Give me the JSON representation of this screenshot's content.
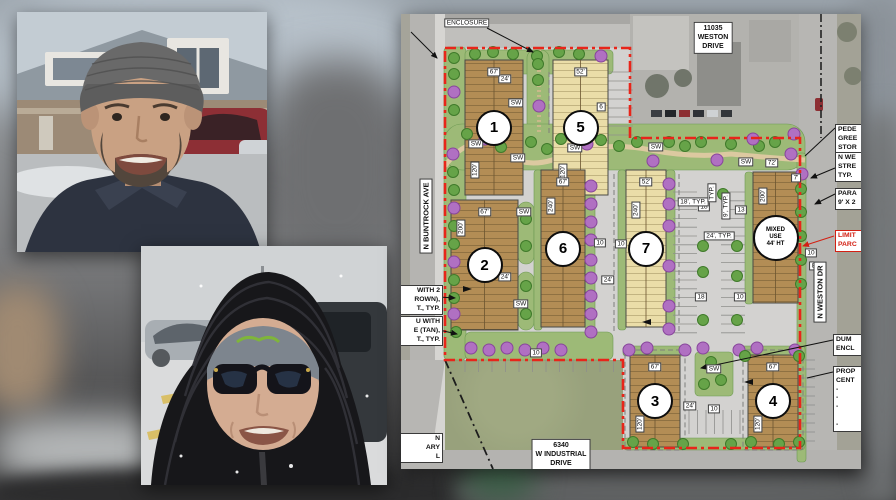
{
  "meta": {
    "description": "News composite: two winter portraits beside a colored development site plan overlaid on a blurred street photo"
  },
  "photos": {
    "man": {
      "name": "man-in-knit-beanie-portrait",
      "colors": {
        "sky": "#c3ccd3",
        "roof": "#8f99a1",
        "brick": "#9c8a76",
        "trim": "#e8e6e1",
        "suv_red": "#8d2f35",
        "skin": "#c9a183",
        "beanie": "#696969",
        "beard": "#52463c",
        "jacket": "#2d3340",
        "pavement": "#babdbf"
      }
    },
    "woman": {
      "name": "woman-in-puffer-hood-portrait",
      "colors": {
        "sky": "#d0d3d5",
        "snow": "#dadbdc",
        "car_silver": "#a8aeb3",
        "car_dark": "#34383c",
        "coat": "#17171a",
        "coat_hl": "#33333a",
        "beanie": "#7d858e",
        "beanie_logo": "#7fb53a",
        "skin": "#d4ac92",
        "glasses": "#14141a",
        "lines_yellow": "#d8b84a"
      }
    }
  },
  "plan": {
    "colors": {
      "aerial": "#c7c6c2",
      "site": "#d3d2d0",
      "road": "#b5b4b1",
      "grass": "#98a17c",
      "green": "#9dba77",
      "green_edge": "#6d9a52",
      "path": "#dcc9a0",
      "bldg_brown": "#b38d55",
      "bldg_tan": "#eadda8",
      "hatch": "#6b5530",
      "tree_green": "#66a348",
      "tree_green_edge": "#3f7a2a",
      "tree_purple": "#b070c2",
      "tree_purple_edge": "#87459b",
      "boundary_red": "#e8251a",
      "callout_red": "#d32013"
    },
    "area_label": {
      "t": "ENCLOSURE",
      "x": 66,
      "y": 9
    },
    "address_labels": [
      {
        "lines": [
          "11035",
          "WESTON",
          "DRIVE"
        ],
        "x": 312,
        "y": 24
      },
      {
        "lines": [
          "6340",
          "W INDUSTRIAL",
          "DRIVE"
        ],
        "x": 160,
        "y": 441
      }
    ],
    "street_labels": [
      {
        "t": "N BUNTROCK AVE",
        "x": 25,
        "y": 202,
        "r": -90
      },
      {
        "t": "N WESTON DR",
        "x": 419,
        "y": 278,
        "r": -90
      }
    ],
    "buildings": [
      {
        "n": "1",
        "x": 64,
        "y": 46,
        "w": 58,
        "h": 135,
        "f": "b",
        "td": "67'",
        "sd": "120'",
        "sdy": 156
      },
      {
        "n": "5",
        "x": 152,
        "y": 46,
        "w": 55,
        "h": 135,
        "f": "t",
        "td": "52'",
        "sd": "120'",
        "sdy": 158
      },
      {
        "n": "2",
        "x": 50,
        "y": 186,
        "w": 67,
        "h": 130,
        "f": "b",
        "td": "67'",
        "sd": "200'",
        "sdy": 214
      },
      {
        "n": "6",
        "x": 140,
        "y": 156,
        "w": 44,
        "h": 157,
        "f": "b",
        "td": "67'",
        "sd": "240'",
        "sdy": 192
      },
      {
        "n": "7",
        "x": 225,
        "y": 156,
        "w": 40,
        "h": 157,
        "f": "t",
        "td": "52'",
        "sd": "240'",
        "sdy": 196
      },
      {
        "n": "3",
        "x": 229,
        "y": 341,
        "w": 50,
        "h": 92,
        "f": "b",
        "td": "67'",
        "sd": "120'",
        "sdy": 410
      },
      {
        "n": "4",
        "x": 347,
        "y": 341,
        "w": 50,
        "h": 92,
        "f": "b",
        "td": "67'",
        "sd": "120'",
        "sdy": 410
      },
      {
        "n": "",
        "x": 352,
        "y": 158,
        "w": 45,
        "h": 131,
        "f": "b",
        "td": "",
        "sd": "200'",
        "sdy": 182,
        "circle_lines": [
          "MIXED",
          "USE",
          "44' HT"
        ]
      }
    ],
    "labels": [
      {
        "t": "SW",
        "x": 75,
        "y": 130
      },
      {
        "t": "SW",
        "x": 117,
        "y": 144
      },
      {
        "t": "SW",
        "x": 174,
        "y": 134
      },
      {
        "t": "SW",
        "x": 255,
        "y": 133
      },
      {
        "t": "SW",
        "x": 345,
        "y": 148
      },
      {
        "t": "SW",
        "x": 115,
        "y": 89
      },
      {
        "t": "SW",
        "x": 123,
        "y": 198
      },
      {
        "t": "SW",
        "x": 120,
        "y": 290
      },
      {
        "t": "SW",
        "x": 313,
        "y": 355
      },
      {
        "t": "6",
        "x": 200,
        "y": 93
      },
      {
        "t": "10",
        "x": 199,
        "y": 229
      },
      {
        "t": "10",
        "x": 220,
        "y": 230
      },
      {
        "t": "10",
        "x": 135,
        "y": 339
      },
      {
        "t": "10",
        "x": 339,
        "y": 283
      },
      {
        "t": "10",
        "x": 410,
        "y": 239
      },
      {
        "t": "10",
        "x": 313,
        "y": 395
      },
      {
        "t": "18",
        "x": 303,
        "y": 193
      },
      {
        "t": "18",
        "x": 300,
        "y": 283
      },
      {
        "t": "13",
        "x": 340,
        "y": 196
      },
      {
        "t": "24'",
        "x": 104,
        "y": 65
      },
      {
        "t": "24'",
        "x": 104,
        "y": 263
      },
      {
        "t": "24'",
        "x": 207,
        "y": 266
      },
      {
        "t": "24'",
        "x": 289,
        "y": 392
      },
      {
        "t": "72'",
        "x": 371,
        "y": 149
      },
      {
        "t": "7'",
        "x": 395,
        "y": 164
      },
      {
        "t": "8'",
        "x": 413,
        "y": 252
      },
      {
        "t": "18', TYP.",
        "x": 292,
        "y": 188
      },
      {
        "t": "24', TYP.",
        "x": 318,
        "y": 222
      },
      {
        "t": "9', TYP.",
        "x": 325,
        "y": 192,
        "r": -90
      },
      {
        "t": "TYP.",
        "x": 311,
        "y": 179,
        "r": -90
      }
    ],
    "callouts_right": [
      {
        "lines": [
          "PEDE",
          "GREE",
          "STOR"
        ],
        "x": 434,
        "y": 110
      },
      {
        "lines": [
          "N WE",
          "STRE",
          "TYP."
        ],
        "x": 434,
        "y": 138
      },
      {
        "lines": [
          "PARA",
          "9' X 2"
        ],
        "x": 434,
        "y": 174
      },
      {
        "lines": [
          "LIMIT",
          "PARC"
        ],
        "x": 434,
        "y": 216,
        "red": true
      },
      {
        "lines": [
          "DUM",
          "ENCL"
        ],
        "x": 432,
        "y": 320
      },
      {
        "lines": [
          "PROP",
          "CENT",
          "-",
          "-",
          "-",
          "",
          "-"
        ],
        "x": 432,
        "y": 352
      }
    ],
    "callouts_left": [
      {
        "lines": [
          "WITH 2",
          "ROWN),",
          "T., TYP."
        ],
        "y": 271
      },
      {
        "lines": [
          "U WITH",
          "E (TAN),",
          "T., TYP."
        ],
        "y": 302
      },
      {
        "lines": [
          "N",
          "ARY",
          "L"
        ],
        "y": 419
      }
    ],
    "trees": [
      [
        53,
        44,
        "g"
      ],
      [
        53,
        60,
        "g"
      ],
      [
        53,
        78,
        "p"
      ],
      [
        53,
        96,
        "g"
      ],
      [
        52,
        140,
        "p"
      ],
      [
        52,
        158,
        "g"
      ],
      [
        53,
        176,
        "g"
      ],
      [
        53,
        194,
        "p"
      ],
      [
        53,
        212,
        "g"
      ],
      [
        53,
        230,
        "g"
      ],
      [
        53,
        248,
        "p"
      ],
      [
        53,
        266,
        "g"
      ],
      [
        53,
        284,
        "g"
      ],
      [
        53,
        300,
        "p"
      ],
      [
        55,
        318,
        "g"
      ],
      [
        74,
        40,
        "g"
      ],
      [
        92,
        38,
        "g"
      ],
      [
        112,
        40,
        "g"
      ],
      [
        136,
        42,
        "g"
      ],
      [
        158,
        38,
        "g"
      ],
      [
        178,
        40,
        "g"
      ],
      [
        200,
        42,
        "p"
      ],
      [
        137,
        50,
        "g"
      ],
      [
        137,
        66,
        "g"
      ],
      [
        138,
        92,
        "p"
      ],
      [
        66,
        120,
        "g"
      ],
      [
        84,
        125,
        "p"
      ],
      [
        100,
        133,
        "g"
      ],
      [
        130,
        128,
        "g"
      ],
      [
        146,
        135,
        "g"
      ],
      [
        160,
        125,
        "g"
      ],
      [
        186,
        130,
        "p"
      ],
      [
        200,
        126,
        "g"
      ],
      [
        218,
        132,
        "g"
      ],
      [
        236,
        128,
        "g"
      ],
      [
        252,
        147,
        "p"
      ],
      [
        268,
        128,
        "g"
      ],
      [
        284,
        132,
        "g"
      ],
      [
        300,
        128,
        "g"
      ],
      [
        316,
        146,
        "p"
      ],
      [
        330,
        130,
        "g"
      ],
      [
        358,
        132,
        "g"
      ],
      [
        374,
        128,
        "g"
      ],
      [
        390,
        140,
        "p"
      ],
      [
        352,
        125,
        "p"
      ],
      [
        393,
        120,
        "p"
      ],
      [
        125,
        205,
        "g"
      ],
      [
        125,
        232,
        "g"
      ],
      [
        125,
        272,
        "g"
      ],
      [
        125,
        300,
        "g"
      ],
      [
        190,
        172,
        "p"
      ],
      [
        190,
        190,
        "p"
      ],
      [
        190,
        208,
        "p"
      ],
      [
        190,
        226,
        "p"
      ],
      [
        190,
        246,
        "p"
      ],
      [
        190,
        264,
        "p"
      ],
      [
        190,
        282,
        "p"
      ],
      [
        190,
        300,
        "p"
      ],
      [
        190,
        318,
        "p"
      ],
      [
        268,
        170,
        "p"
      ],
      [
        268,
        190,
        "p"
      ],
      [
        268,
        212,
        "p"
      ],
      [
        268,
        252,
        "p"
      ],
      [
        268,
        292,
        "p"
      ],
      [
        268,
        315,
        "p"
      ],
      [
        302,
        232,
        "g"
      ],
      [
        302,
        258,
        "g"
      ],
      [
        336,
        232,
        "g"
      ],
      [
        336,
        262,
        "g"
      ],
      [
        302,
        306,
        "g"
      ],
      [
        336,
        306,
        "g"
      ],
      [
        322,
        180,
        "g"
      ],
      [
        400,
        175,
        "g"
      ],
      [
        400,
        198,
        "g"
      ],
      [
        400,
        222,
        "g"
      ],
      [
        400,
        246,
        "g"
      ],
      [
        400,
        270,
        "g"
      ],
      [
        401,
        160,
        "p"
      ],
      [
        70,
        334,
        "p"
      ],
      [
        88,
        336,
        "p"
      ],
      [
        106,
        334,
        "p"
      ],
      [
        124,
        336,
        "p"
      ],
      [
        142,
        334,
        "p"
      ],
      [
        160,
        336,
        "p"
      ],
      [
        228,
        336,
        "p"
      ],
      [
        246,
        334,
        "p"
      ],
      [
        284,
        336,
        "p"
      ],
      [
        302,
        334,
        "p"
      ],
      [
        338,
        336,
        "p"
      ],
      [
        356,
        334,
        "p"
      ],
      [
        394,
        336,
        "p"
      ],
      [
        310,
        348,
        "g"
      ],
      [
        320,
        366,
        "g"
      ],
      [
        303,
        370,
        "g"
      ],
      [
        344,
        342,
        "g"
      ],
      [
        398,
        342,
        "g"
      ],
      [
        232,
        428,
        "g"
      ],
      [
        252,
        430,
        "g"
      ],
      [
        282,
        430,
        "g"
      ],
      [
        330,
        430,
        "g"
      ],
      [
        350,
        428,
        "g"
      ],
      [
        378,
        430,
        "g"
      ],
      [
        398,
        428,
        "g"
      ]
    ]
  }
}
